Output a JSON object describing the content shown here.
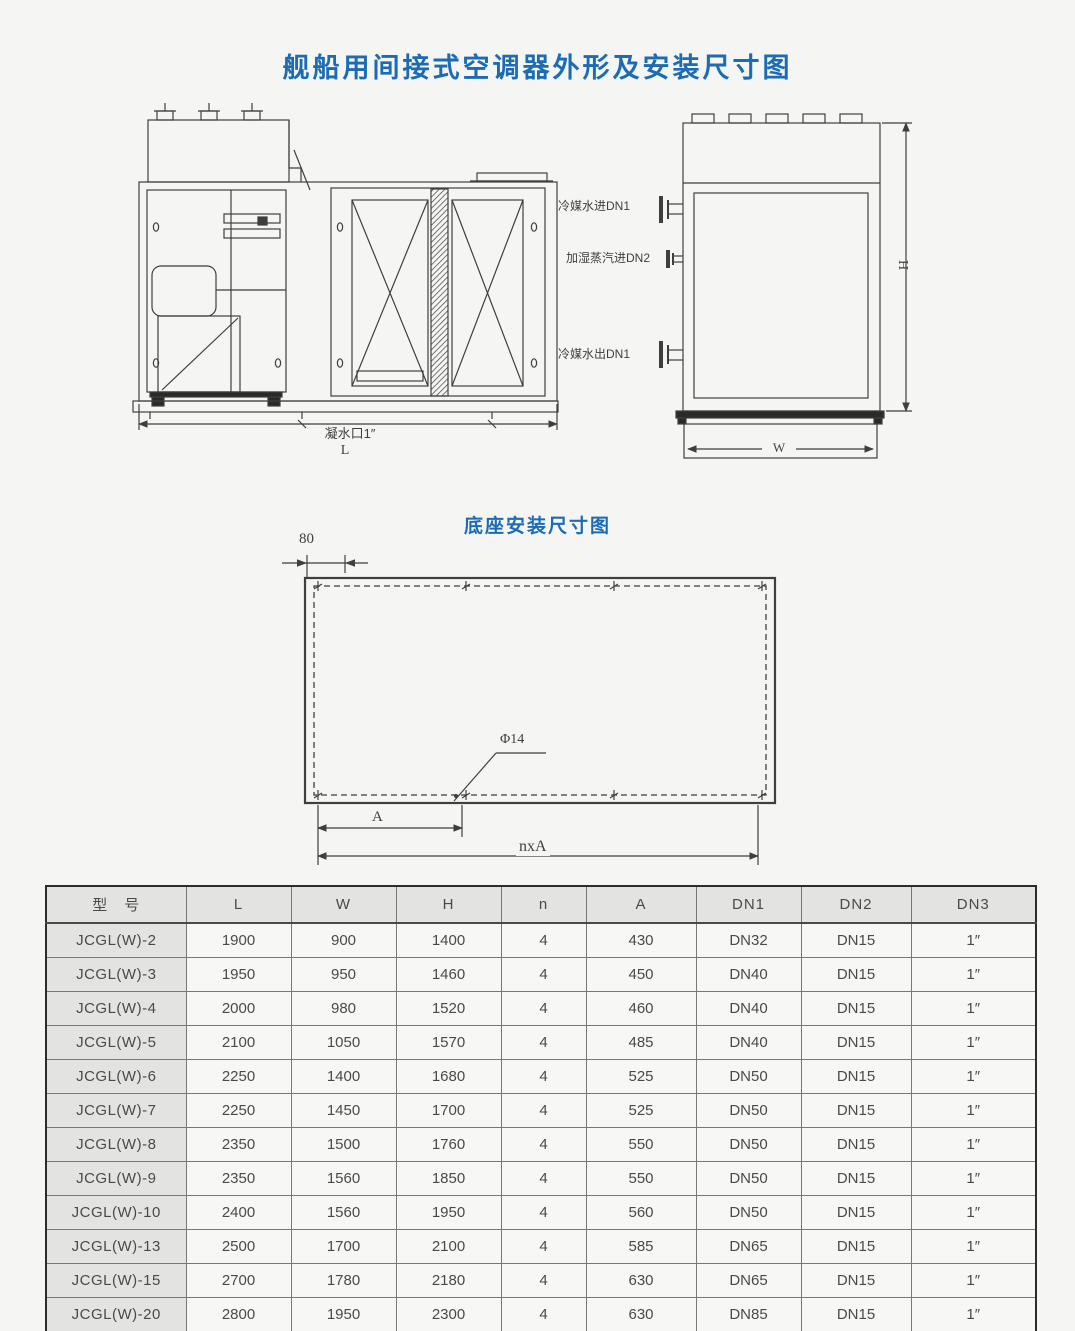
{
  "page": {
    "title": "舰船用间接式空调器外形及安装尺寸图"
  },
  "colors": {
    "title_blue": "#1b6cb4",
    "drawing_line": "#3f3f3f",
    "table_header_bg": "#e3e3e1"
  },
  "drawing": {
    "front_view": {
      "condensate_label": "凝水口1″",
      "dim_l": "L"
    },
    "side_view": {
      "pipes": [
        "冷媒水进DN1",
        "加湿蒸汽进DN2",
        "冷媒水出DN1"
      ],
      "dim_h": "H",
      "dim_w": "W"
    },
    "base_view": {
      "title": "底座安装尺寸图",
      "dim_80": "80",
      "hole_label": "Φ14",
      "dim_a": "A",
      "dim_nxa": "nxA"
    }
  },
  "table": {
    "headers": [
      "型　号",
      "L",
      "W",
      "H",
      "n",
      "A",
      "DN1",
      "DN2",
      "DN3"
    ],
    "rows": [
      [
        "JCGL(W)-2",
        "1900",
        "900",
        "1400",
        "4",
        "430",
        "DN32",
        "DN15",
        "1″"
      ],
      [
        "JCGL(W)-3",
        "1950",
        "950",
        "1460",
        "4",
        "450",
        "DN40",
        "DN15",
        "1″"
      ],
      [
        "JCGL(W)-4",
        "2000",
        "980",
        "1520",
        "4",
        "460",
        "DN40",
        "DN15",
        "1″"
      ],
      [
        "JCGL(W)-5",
        "2100",
        "1050",
        "1570",
        "4",
        "485",
        "DN40",
        "DN15",
        "1″"
      ],
      [
        "JCGL(W)-6",
        "2250",
        "1400",
        "1680",
        "4",
        "525",
        "DN50",
        "DN15",
        "1″"
      ],
      [
        "JCGL(W)-7",
        "2250",
        "1450",
        "1700",
        "4",
        "525",
        "DN50",
        "DN15",
        "1″"
      ],
      [
        "JCGL(W)-8",
        "2350",
        "1500",
        "1760",
        "4",
        "550",
        "DN50",
        "DN15",
        "1″"
      ],
      [
        "JCGL(W)-9",
        "2350",
        "1560",
        "1850",
        "4",
        "550",
        "DN50",
        "DN15",
        "1″"
      ],
      [
        "JCGL(W)-10",
        "2400",
        "1560",
        "1950",
        "4",
        "560",
        "DN50",
        "DN15",
        "1″"
      ],
      [
        "JCGL(W)-13",
        "2500",
        "1700",
        "2100",
        "4",
        "585",
        "DN65",
        "DN15",
        "1″"
      ],
      [
        "JCGL(W)-15",
        "2700",
        "1780",
        "2180",
        "4",
        "630",
        "DN65",
        "DN15",
        "1″"
      ],
      [
        "JCGL(W)-20",
        "2800",
        "1950",
        "2300",
        "4",
        "630",
        "DN85",
        "DN15",
        "1″"
      ]
    ]
  }
}
